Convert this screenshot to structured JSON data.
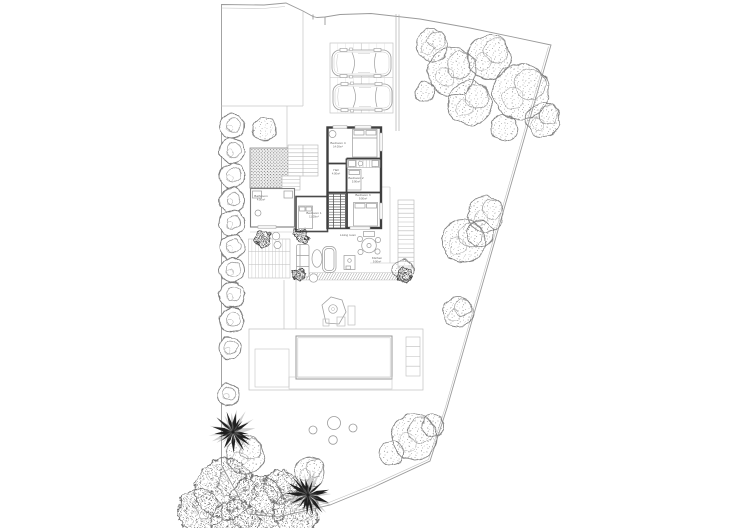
{
  "plan_type": "villa-site-plan",
  "colors": {
    "background": "#ffffff",
    "boundary_line": "#9a9a9a",
    "wall": "#3f3f3f",
    "light_line": "#c2c2c2",
    "mid_line": "#9c9c9c",
    "foliage": "#7d7d7d",
    "dark_foliage": "#222222",
    "label_text": "#666666"
  },
  "rooms": [
    {
      "id": "bedroom-4",
      "name": "Bedroom 4",
      "area": "14.00m²",
      "x": 338,
      "y": 144
    },
    {
      "id": "hall",
      "name": "Hall",
      "area": "4.00m²",
      "x": 336,
      "y": 171
    },
    {
      "id": "bedroom-2",
      "name": "Bedroom 2",
      "area": "5.90m²",
      "x": 356,
      "y": 179
    },
    {
      "id": "bedroom-3",
      "name": "Bedroom 3",
      "area": "9.00m²",
      "x": 363,
      "y": 196
    },
    {
      "id": "bedroom-1",
      "name": "Bedroom 1",
      "area": "11.00m²",
      "x": 314,
      "y": 214
    },
    {
      "id": "bathroom",
      "name": "Bathroom",
      "area": "4.00m²",
      "x": 261,
      "y": 197
    },
    {
      "id": "living-room",
      "name": "Living room",
      "area": "",
      "x": 348,
      "y": 236
    },
    {
      "id": "kitchen",
      "name": "Kitchen",
      "area": "9.00m²",
      "x": 377,
      "y": 259
    }
  ],
  "vehicles": [
    {
      "id": "car-1",
      "x": 332,
      "y": 50
    },
    {
      "id": "car-2",
      "x": 333,
      "y": 84
    }
  ],
  "pool": {
    "x": 296,
    "y": 336,
    "w": 96,
    "h": 43
  },
  "stepping_stones": [
    {
      "x": 334,
      "y": 423,
      "r": 6.5
    },
    {
      "x": 313,
      "y": 430,
      "r": 4
    },
    {
      "x": 353,
      "y": 428,
      "r": 4
    },
    {
      "x": 333,
      "y": 440,
      "r": 4.3
    }
  ],
  "landscape": {
    "hedge_shrubs": [
      {
        "x": 232,
        "y": 126,
        "r": 12.5
      },
      {
        "x": 232,
        "y": 151,
        "r": 12.5
      },
      {
        "x": 232,
        "y": 176,
        "r": 12.5
      },
      {
        "x": 232,
        "y": 200,
        "r": 12.5
      },
      {
        "x": 232,
        "y": 223,
        "r": 12.5
      },
      {
        "x": 232,
        "y": 247,
        "r": 12.5
      },
      {
        "x": 232,
        "y": 270,
        "r": 12.5
      },
      {
        "x": 232,
        "y": 295,
        "r": 12.5
      },
      {
        "x": 232,
        "y": 320,
        "r": 12
      },
      {
        "x": 230,
        "y": 348,
        "r": 11
      },
      {
        "x": 228,
        "y": 395,
        "r": 11
      }
    ],
    "trees": [
      {
        "x": 265,
        "y": 129,
        "r": 12
      },
      {
        "x": 432,
        "y": 45,
        "r": 16
      },
      {
        "x": 452,
        "y": 72,
        "r": 24
      },
      {
        "x": 489,
        "y": 57,
        "r": 22
      },
      {
        "x": 470,
        "y": 103,
        "r": 22
      },
      {
        "x": 521,
        "y": 92,
        "r": 28
      },
      {
        "x": 543,
        "y": 120,
        "r": 17
      },
      {
        "x": 504,
        "y": 128,
        "r": 13
      },
      {
        "x": 425,
        "y": 92,
        "r": 10
      },
      {
        "x": 486,
        "y": 214,
        "r": 18
      },
      {
        "x": 464,
        "y": 241,
        "r": 22
      },
      {
        "x": 480,
        "y": 234,
        "r": 13
      },
      {
        "x": 458,
        "y": 312,
        "r": 15
      },
      {
        "x": 414,
        "y": 437,
        "r": 23
      },
      {
        "x": 392,
        "y": 453,
        "r": 12
      },
      {
        "x": 433,
        "y": 426,
        "r": 11
      },
      {
        "x": 403,
        "y": 270,
        "r": 10
      },
      {
        "x": 245,
        "y": 455,
        "r": 19
      },
      {
        "x": 310,
        "y": 472,
        "r": 15
      }
    ],
    "dense_trees": [
      {
        "x": 225,
        "y": 489,
        "r": 30
      },
      {
        "x": 257,
        "y": 504,
        "r": 28
      },
      {
        "x": 200,
        "y": 511,
        "r": 22
      },
      {
        "x": 236,
        "y": 524,
        "r": 24
      },
      {
        "x": 281,
        "y": 486,
        "r": 17
      },
      {
        "x": 296,
        "y": 513,
        "r": 22
      }
    ],
    "palms": [
      {
        "x": 233,
        "y": 432,
        "r": 22
      },
      {
        "x": 308,
        "y": 495,
        "r": 23
      }
    ],
    "dark_bushes": [
      {
        "x": 263,
        "y": 239,
        "r": 8
      },
      {
        "x": 301,
        "y": 236,
        "r": 7
      },
      {
        "x": 299,
        "y": 275,
        "r": 6
      },
      {
        "x": 404,
        "y": 275,
        "r": 7
      }
    ],
    "planters": [
      {
        "x": 276,
        "y": 236,
        "r": 3.8
      },
      {
        "x": 277.5,
        "y": 245,
        "r": 3.6
      }
    ]
  }
}
